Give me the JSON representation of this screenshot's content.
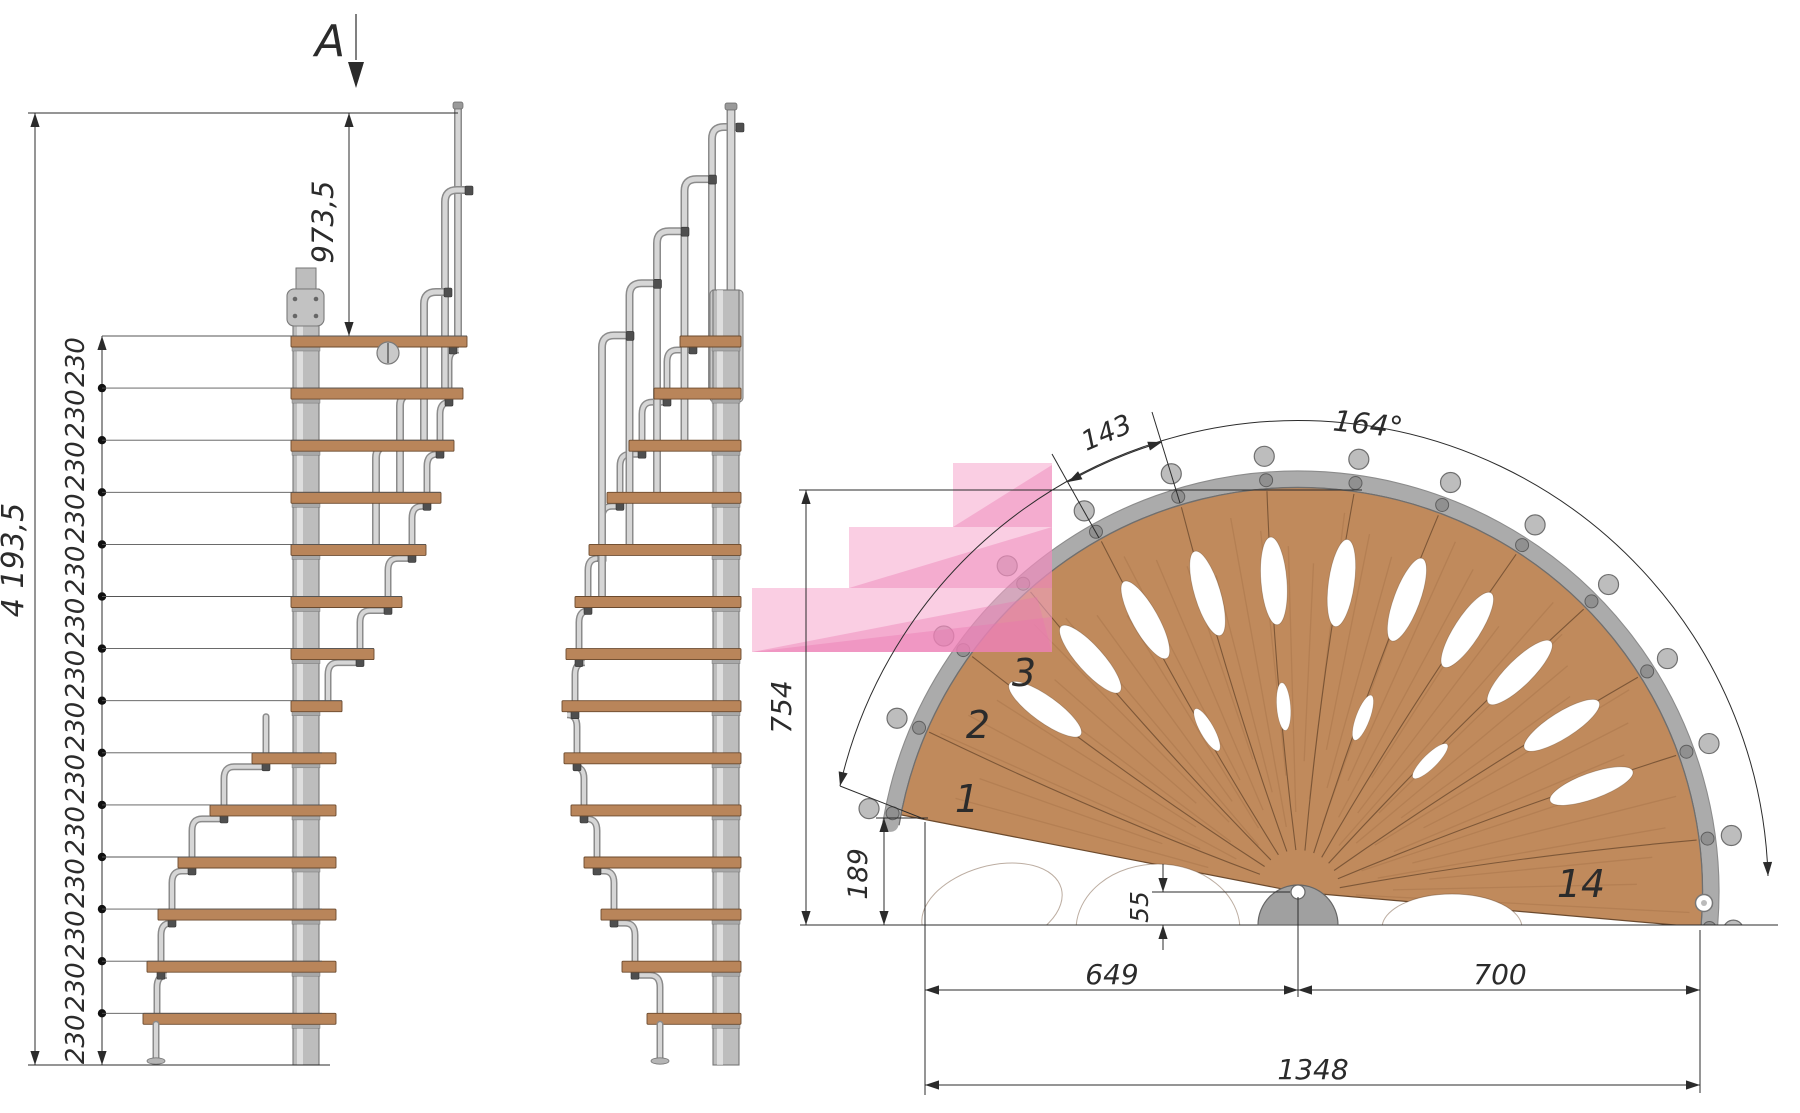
{
  "title": "Spiral staircase technical drawing",
  "section_view": {
    "label": "A"
  },
  "elevation": {
    "total_height_label": "4 193,5",
    "top_rise_label": "973,5",
    "step_rise_label": "230",
    "step_rise_count": 14
  },
  "plan": {
    "tread_spacing_label": "143",
    "rotation_angle_label": "164°",
    "height_label": "754",
    "entry_offset_label": "189",
    "center_offset_label": "55",
    "left_width_label": "649",
    "right_width_label": "700",
    "total_width_label": "1348",
    "step_numbers": [
      "1",
      "2",
      "3",
      "14"
    ]
  },
  "colors": {
    "wood_plan": "#c08a5c",
    "wood_tread": "#b9855a",
    "wood_edge": "#6b4a2e",
    "metal_light": "#d6d6d6",
    "metal_mid": "#ababab",
    "metal_dark": "#6f6f6f",
    "tube_outline": "#8b8b8b",
    "column": "#bdbdbd",
    "column_edge": "#767676",
    "highlight_pink": "rgba(246,166,204,0.55)",
    "highlight_pink_deep": "rgba(234,118,176,0.38)",
    "dimension": "#2b2b2b"
  }
}
